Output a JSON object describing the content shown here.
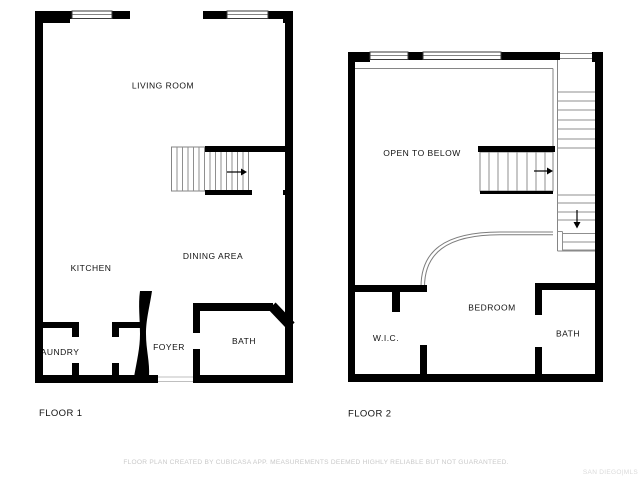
{
  "floor1": {
    "label": "FLOOR 1",
    "rooms": {
      "living_room": "LIVING ROOM",
      "kitchen": "KITCHEN",
      "dining_area": "DINING AREA",
      "laundry": "LAUNDRY",
      "foyer": "FOYER",
      "bath": "BATH"
    }
  },
  "floor2": {
    "label": "FLOOR 2",
    "rooms": {
      "open_to_below": "OPEN TO BELOW",
      "wic": "W.I.C.",
      "bedroom": "BEDROOM",
      "bath": "BATH"
    }
  },
  "footer": {
    "disclaimer": "FLOOR PLAN CREATED BY CUBICASA APP. MEASUREMENTS DEEMED HIGHLY RELIABLE BUT NOT GUARANTEED.",
    "watermark": "SAN DIEGO|MLS"
  },
  "colors": {
    "wall": "#000000",
    "label": "#111111",
    "thin_line": "#858585",
    "disclaimer_text": "#c9c9c9",
    "watermark_text": "#dadada",
    "background": "#ffffff"
  }
}
